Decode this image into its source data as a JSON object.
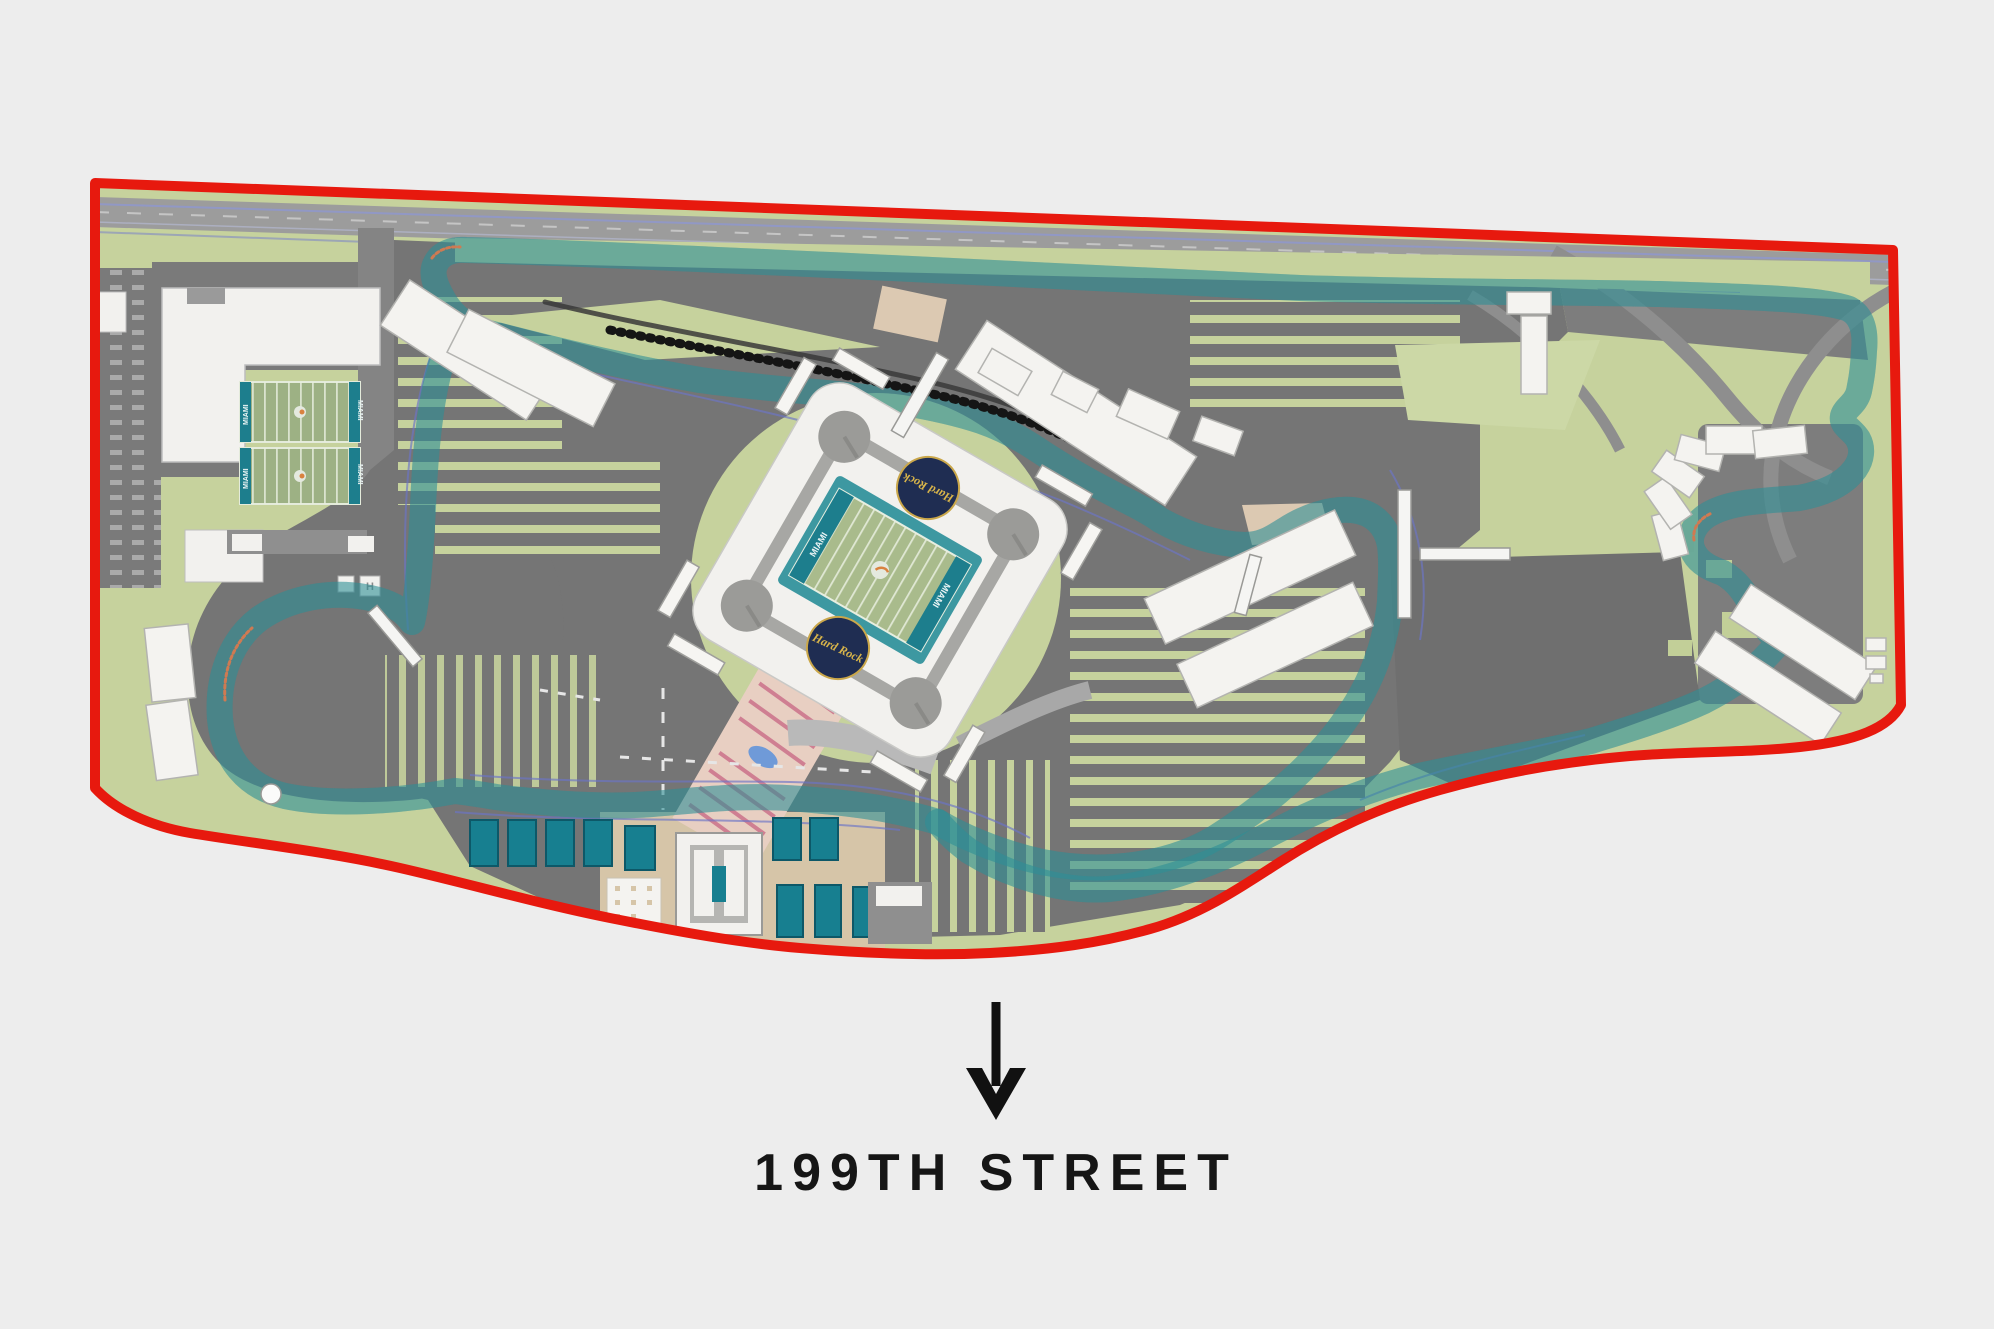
{
  "map": {
    "title": "Hard Rock Stadium Formula 1 circuit site plan",
    "street_label": "199TH STREET",
    "arrow_icon": "arrow-down-icon",
    "stadium": {
      "logo_label": "Hard Rock",
      "endzone_label": "MIAMI"
    },
    "practice_fields": {
      "endzone_label": "MIAMI"
    },
    "helipad_label": "H",
    "colors": {
      "background": "#ededed",
      "boundary_red": "#e7190e",
      "site_green": "#c6d29d",
      "paving_gray": "#757575",
      "track_black": "#1c1c1c",
      "track_edge_blue": "#4353b8",
      "track_glow_teal": "#2f8e96",
      "stadium_white": "#f2f1ee",
      "field_teal": "#1d7e8d",
      "apron_teal": "#3d98a1",
      "court_teal": "#177f90",
      "plaza_tan": "#d6c5a8",
      "runoff_tan": "#dcc9b2",
      "crosswalk_pink": "#cf7f92"
    }
  }
}
